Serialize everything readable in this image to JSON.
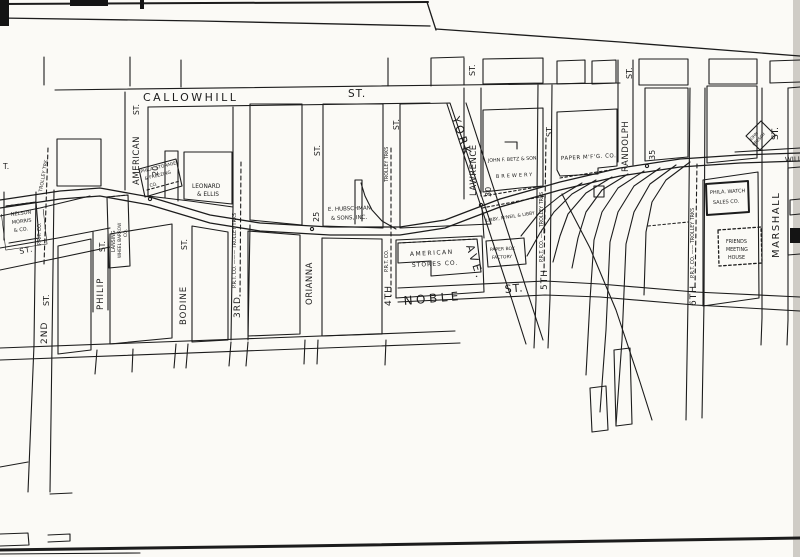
{
  "map_name": "railroad-street-map",
  "ink_color": "#1c1c1c",
  "paper_color": "#fbfaf6",
  "streets": {
    "callowhill": "CALLOWHILL",
    "callowhill_st": "ST.",
    "noble": "NOBLE",
    "noble_st": "ST.",
    "york": "YORK",
    "york_ave": "AVE.",
    "second": "2ND",
    "second_st": "ST.",
    "philip": "PHILIP",
    "philip_st": "ST.",
    "american": "AMERICAN",
    "american_st": "ST.",
    "bodine": "BODINE",
    "bodine_st": "ST.",
    "third": "3RD",
    "orianna": "ORIANNA",
    "orianna_st": "ST.",
    "fourth": "4TH",
    "fourth_st": "ST.",
    "lawrence": "LAWRENCE",
    "lawrence_st": "ST.",
    "fifth": "5TH",
    "fifth_st": "ST.",
    "randolph": "RANDOLPH",
    "randolph_st": "ST.",
    "sixth": "6TH",
    "marshall": "MARSHALL",
    "marshall_st": "ST.",
    "willow": "WILLOW",
    "diag_st": "ST.",
    "edge_fragment": "T."
  },
  "railroad": {
    "markers": {
      "m20": "20",
      "m25": "25",
      "m30": "30",
      "m35": "35"
    },
    "trolley": {
      "second_a": "TROLLEY TRK",
      "second_b": "P.R.T. CO.",
      "third": "P.R.T. CO. ——— TROLLEY TRKS",
      "fourth_a": "TROLLEY TRKS",
      "fourth_b": "P.R.T. CO.",
      "fifth": "P.R.T. CO. —— TROLLEY TRKS",
      "sixth": "P.R.T. CO. —— TROLLEY TRKS"
    }
  },
  "buildings": {
    "nelson_morris": [
      "NELSON",
      "MORRIS",
      "& CO."
    ],
    "lansing": [
      "LANSING",
      "WHEEL BARROW",
      "CO."
    ],
    "phila_storage": [
      "PHILA. STORAGE",
      "& FREEZING",
      "CO."
    ],
    "leonard_ellis": [
      "LEONARD",
      "& ELLIS"
    ],
    "hubschman": [
      "E. HUBSCHMAN",
      "& SONS, INC."
    ],
    "american_stores": [
      "AMERICAN",
      "STORES  CO."
    ],
    "paper_box": [
      "PAPER BOX",
      "FACTORY"
    ],
    "libby": "LIBBY, M'NEIL & LIBBY",
    "betz": [
      "JOHN F. BETZ & SON",
      "BREWERY"
    ],
    "paper_mfg": "PAPER M'F'G. CO.",
    "phila_watch": [
      "PHILA. WATCH",
      "SALES CO."
    ],
    "friends": [
      "FRIENDS",
      "MEETING",
      "HOUSE"
    ],
    "bresch": [
      "JOHN",
      "BRESCH"
    ]
  }
}
